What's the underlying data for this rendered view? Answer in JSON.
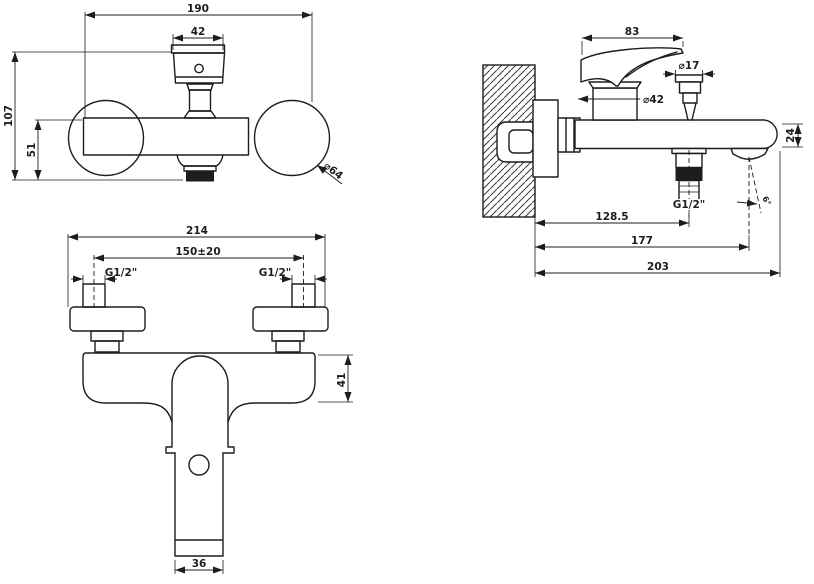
{
  "drawing": {
    "type": "technical-dimension-drawing",
    "subject": "wall-mounted bath-shower mixer",
    "units": "mm",
    "colors": {
      "line": "#1d1d1d",
      "background": "#ffffff"
    },
    "views": {
      "front": {
        "label": "front view",
        "dims": {
          "overall_width": "190",
          "cartridge_width": "42",
          "overall_height": "107",
          "lower_height": "51",
          "flange_diameter": "⌀64"
        }
      },
      "side": {
        "label": "side view",
        "dims": {
          "handle_length": "83",
          "hose_connector_diameter": "⌀17",
          "body_diameter": "⌀42",
          "end_height": "24",
          "outlet_thread": "G1/2\"",
          "wall_to_outlet": "128.5",
          "wall_to_spout": "177",
          "total_projection": "203",
          "spout_angle": "6°"
        }
      },
      "top": {
        "label": "top view",
        "dims": {
          "overall_width": "214",
          "inlet_spacing": "150±20",
          "inlet_thread_left": "G1/2\"",
          "inlet_thread_right": "G1/2\"",
          "body_depth": "41",
          "handle_width": "36"
        }
      }
    }
  }
}
